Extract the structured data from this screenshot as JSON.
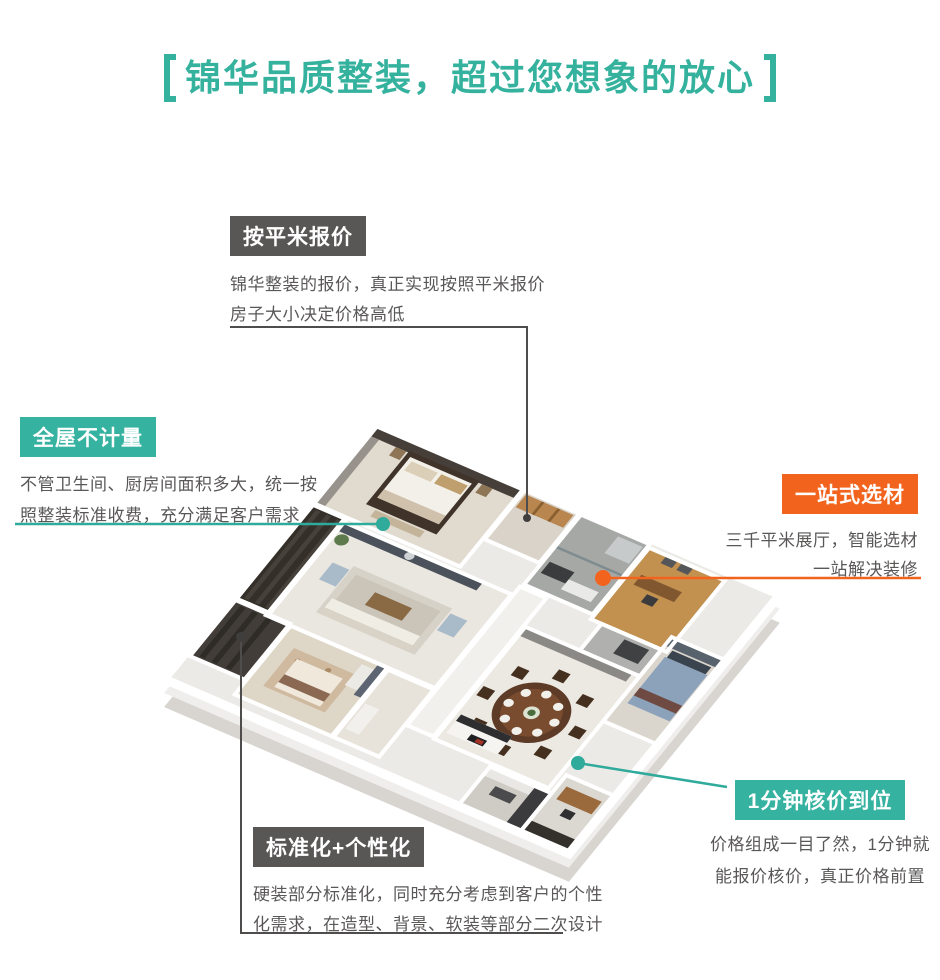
{
  "title": {
    "text": "锦华品质整装，超过您想象的放心"
  },
  "colors": {
    "teal": "#35b2a0",
    "orange": "#f2641e",
    "dark_gray": "#595656",
    "desc_text": "#5a5757",
    "connector_dark": "#4f4c4c",
    "background": "#ffffff"
  },
  "illustration": {
    "name": "isometric-apartment-floorplan-render"
  },
  "callouts": [
    {
      "id": "per-sqm",
      "label": "按平米报价",
      "desc1": "锦华整装的报价，真正实现按照平米报价",
      "desc2": "房子大小决定价格高低",
      "style": "dark"
    },
    {
      "id": "whole-house",
      "label": "全屋不计量",
      "desc1": "不管卫生间、厨房间面积多大，统一按",
      "desc2": "照整装标准收费，充分满足客户需求",
      "style": "teal"
    },
    {
      "id": "one-stop",
      "label": "一站式选材",
      "desc1": "三千平米展厅，智能选材",
      "desc2": "一站解决装修",
      "style": "orange"
    },
    {
      "id": "one-minute",
      "label": "1分钟核价到位",
      "desc1": "价格组成一目了然，1分钟就",
      "desc2": "能报价核价，真正价格前置",
      "style": "teal"
    },
    {
      "id": "standard",
      "label": "标准化+个性化",
      "desc1": "硬装部分标准化，同时充分考虑到客户的个性",
      "desc2": "化需求，在造型、背景、软装等部分二次设计",
      "style": "dark"
    }
  ]
}
